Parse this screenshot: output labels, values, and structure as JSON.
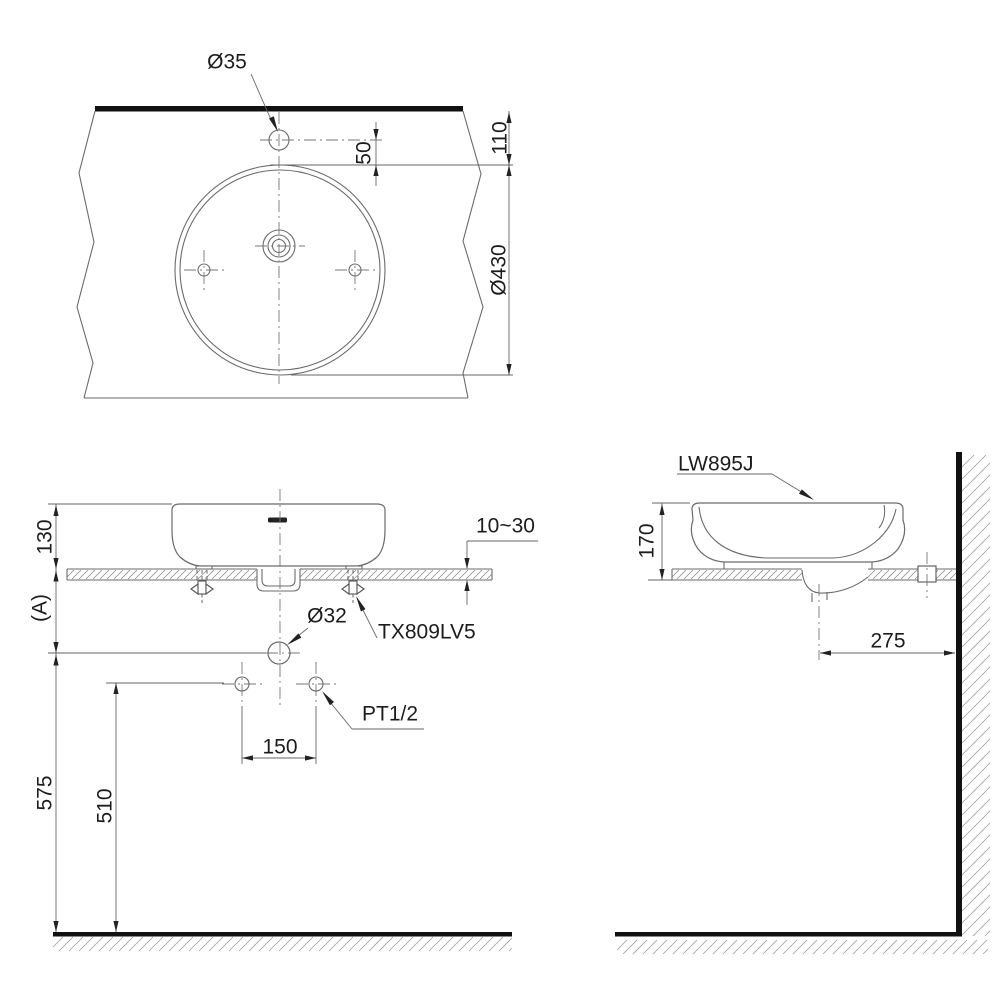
{
  "drawing": {
    "product_model": "LW895J",
    "colors": {
      "ink": "#1c1c1c",
      "outline": "#6b6b6b",
      "solid_sections": "#111111"
    }
  },
  "views": {
    "plan": {
      "dims": {
        "faucet_hole_diameter": "Ø35",
        "hole_to_bowl": "50",
        "counter_edge_to_bowl": "110",
        "bowl_diameter": "Ø430"
      }
    },
    "front": {
      "dims": {
        "height_above_counter": "130",
        "counter_to_drain_ref": "(A)",
        "counter_thickness_range": "10~30",
        "drain_pipe_diameter": "Ø32",
        "supply_hole_spacing": "150",
        "floor_to_supply": "510",
        "floor_to_drain": "575"
      },
      "labels": {
        "drain_fitting_model": "TX809LV5",
        "water_supply_thread": "PT1/2"
      }
    },
    "side": {
      "labels": {
        "product_model": "LW895J"
      },
      "dims": {
        "basin_height": "170",
        "drain_center_to_wall": "275"
      }
    }
  }
}
